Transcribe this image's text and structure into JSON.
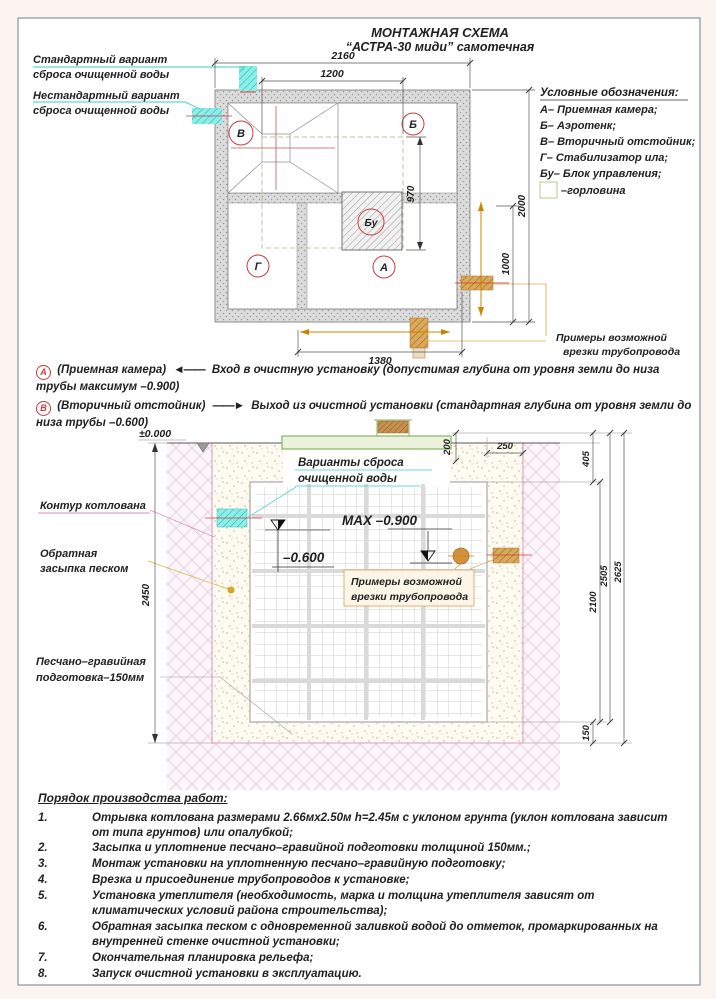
{
  "title": {
    "line1": "МОНТАЖНАЯ СХЕМА",
    "line2": "“АСТРА-30 миди” самотечная"
  },
  "plan": {
    "discharge_standard_l1": "Стандартный вариант",
    "discharge_standard_l2": "сброса очищенной воды",
    "discharge_nonstandard_l1": "Нестандартный вариант",
    "discharge_nonstandard_l2": "сброса очищенной воды",
    "legend": {
      "title": "Условные обозначения:",
      "item_a": "А– Приемная камера;",
      "item_b": "Б– Аэротенк;",
      "item_v": "В– Вторичный отстойник;",
      "item_g": "Г– Стабилизатор ила;",
      "item_bu": "Бу– Блок управления;",
      "item_neck": "–горловина"
    },
    "marks": {
      "v": "В",
      "b": "Б",
      "g": "Г",
      "a": "А",
      "bu": "Бу"
    },
    "dims": {
      "width_total": "2160",
      "width_neck": "1200",
      "neck_depth": "970",
      "height_total": "2000",
      "height_part": "1000",
      "bottom_width": "1380"
    },
    "pipe_note_l1": "Примеры возможной",
    "pipe_note_l2": "врезки трубопровода"
  },
  "notes": {
    "a_marker": "А",
    "a_name": "(Приемная камера)",
    "a_arrow": "◄——",
    "a_text": "Вход в очистную установку (допустимая глубина от уровня земли до низа трубы максимум –0.900)",
    "b_marker": "В",
    "b_name": "(Вторичный отстойник)",
    "b_arrow": "——►",
    "b_text": "Выход из очистной установки (стандартная глубина от уровня земли до низа трубы –0.600)"
  },
  "section": {
    "zero_level": "±0.000",
    "discharge_l1": "Варианты сброса",
    "discharge_l2": "очищенной воды",
    "max_level": "MAX –0.900",
    "mid_level": "–0.600",
    "pit_label": "Контур котлована",
    "backfill_l1": "Обратная",
    "backfill_l2": "засыпка песком",
    "base_l1": "Песчано–гравийная",
    "base_l2": "подготовка–150мм",
    "pipe_note_l1": "Примеры возможной",
    "pipe_note_l2": "врезки трубопровода",
    "dims": {
      "pit_depth": "2450",
      "top_offset": "200",
      "side_offset": "250",
      "lid_offset": "405",
      "tank_height": "2100",
      "tank_bottom": "2505",
      "total_depth": "2625",
      "base_thickness": "150"
    }
  },
  "worklist": {
    "title": "Порядок производства работ:",
    "items": [
      {
        "num": "1.",
        "text": "Отрывка котлована размерами 2.66мх2.50м h=2.45м с уклоном грунта (уклон котлована зависит от типа грунтов) или опалубкой;"
      },
      {
        "num": "2.",
        "text": "Засыпка и уплотнение песчано–гравийной подготовки толщиной 150мм.;"
      },
      {
        "num": "3.",
        "text": "Монтаж установки на уплотненную песчано–гравийную подготовку;"
      },
      {
        "num": "4.",
        "text": "Врезка и присоединение трубопроводов к установке;"
      },
      {
        "num": "5.",
        "text": "Установка утеплителя (необходимость, марка и толщина утеплителя зависят от климатических условий района строительства);"
      },
      {
        "num": "6.",
        "text": "Обратная засыпка песком с одновременной заливкой водой до отметок, промаркированных на внутренней стенке очистной установки;"
      },
      {
        "num": "7.",
        "text": "Окончательная планировка рельефа;"
      },
      {
        "num": "8.",
        "text": "Запуск очистной установки в эксплуатацию."
      }
    ]
  }
}
